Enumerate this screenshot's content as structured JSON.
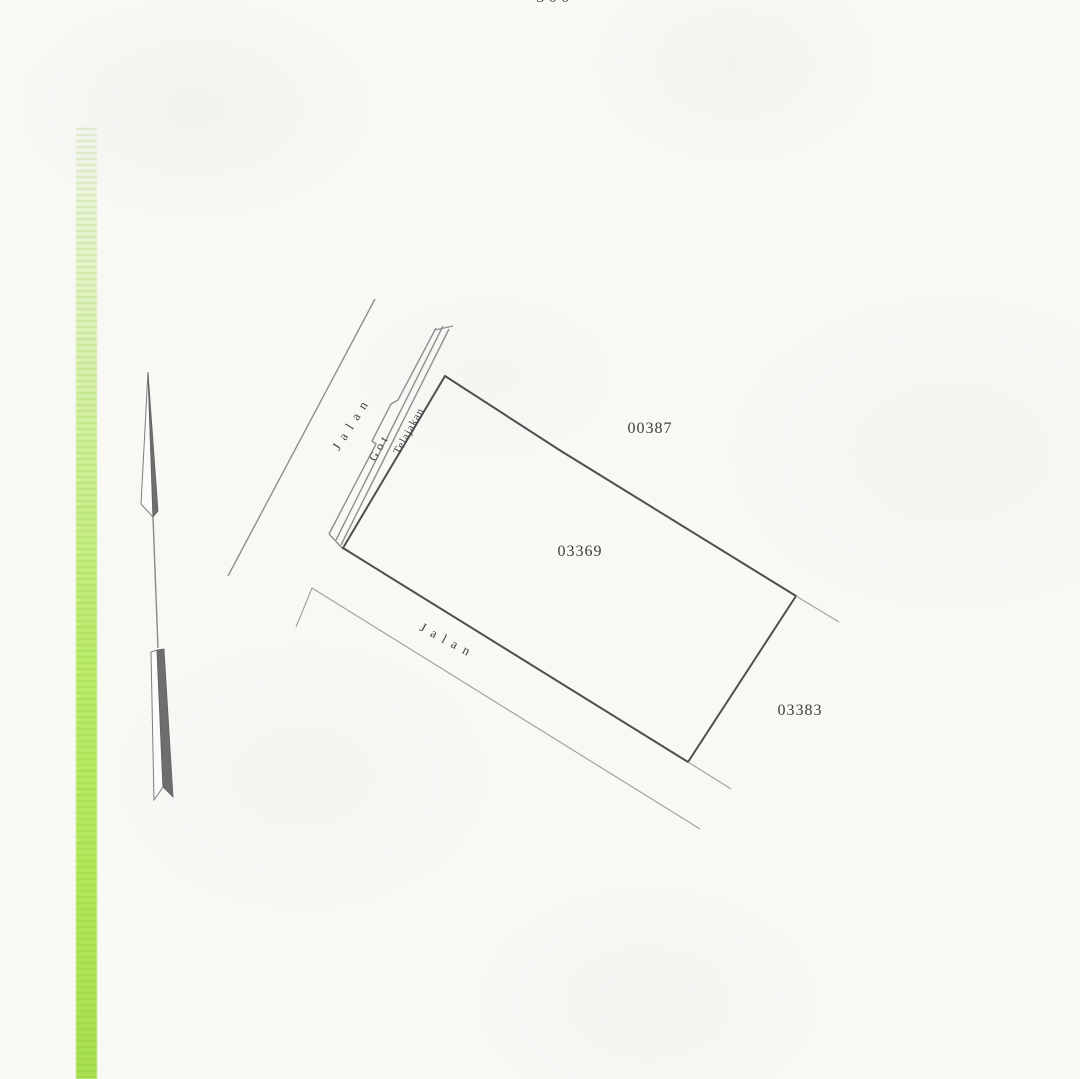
{
  "page": {
    "top_partial_text": "500"
  },
  "sketch": {
    "subject_parcel_label": "03369",
    "neighbor_parcel_top_label": "00387",
    "neighbor_parcel_right_label": "03383",
    "road_upper_label": "Jalan",
    "road_lower_label": "Jalan",
    "gutter_label": "Got",
    "verge_label": "Telajakan"
  },
  "colors": {
    "paper": "#f8f8f5",
    "boundary_line_dark": "#4f4f4f",
    "road_line_light": "#9b9b9b",
    "text_ink": "#3e3e3e",
    "binding_green": "#b4e85c"
  }
}
